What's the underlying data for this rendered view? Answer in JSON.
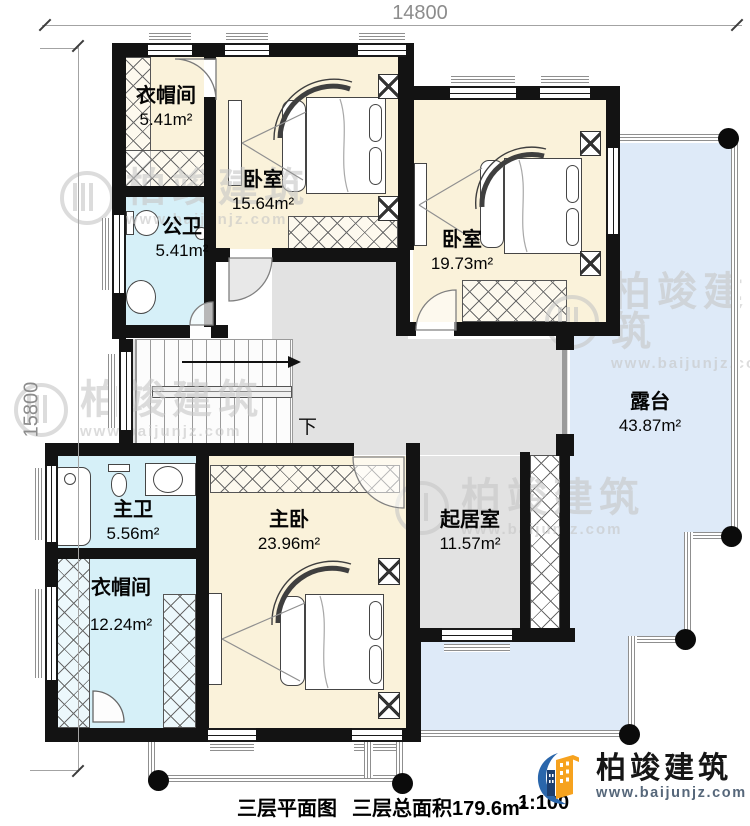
{
  "dimensions": {
    "top": "14800",
    "left": "15800"
  },
  "rooms": [
    {
      "id": "cloakroom-top",
      "name": "衣帽间",
      "area": "5.41m²"
    },
    {
      "id": "bedroom-top",
      "name": "卧室",
      "area": "15.64m²"
    },
    {
      "id": "bath-public",
      "name": "公卫",
      "area": "5.41m²"
    },
    {
      "id": "bedroom-right",
      "name": "卧室",
      "area": "19.73m²"
    },
    {
      "id": "terrace",
      "name": "露台",
      "area": "43.87m²"
    },
    {
      "id": "bath-master",
      "name": "主卫",
      "area": "5.56m²"
    },
    {
      "id": "bedroom-master",
      "name": "主卧",
      "area": "23.96m²"
    },
    {
      "id": "living-room",
      "name": "起居室",
      "area": "11.57m²"
    },
    {
      "id": "cloakroom-bottom",
      "name": "衣帽间",
      "area": "12.24m²"
    }
  ],
  "stairs": {
    "down_label": "下"
  },
  "footer": {
    "plan_title": "三层平面图",
    "total_area_label": "三层总面积179.6m²",
    "scale": "1:100"
  },
  "brand": {
    "name": "柏竣建筑",
    "website": "www.baijunjz.com"
  },
  "watermark": {
    "text": "柏竣建筑",
    "url": "www.baijunjz.com"
  },
  "colors": {
    "wall": "#131313",
    "bedroom_fill": "#FAF2DA",
    "bath_fill": "#D6F0F8",
    "terrace_fill": "#DEEAF8",
    "hall_fill": "#E2E2E2",
    "brand_blue": "#2A66AB",
    "brand_orange": "#F6A21E"
  }
}
